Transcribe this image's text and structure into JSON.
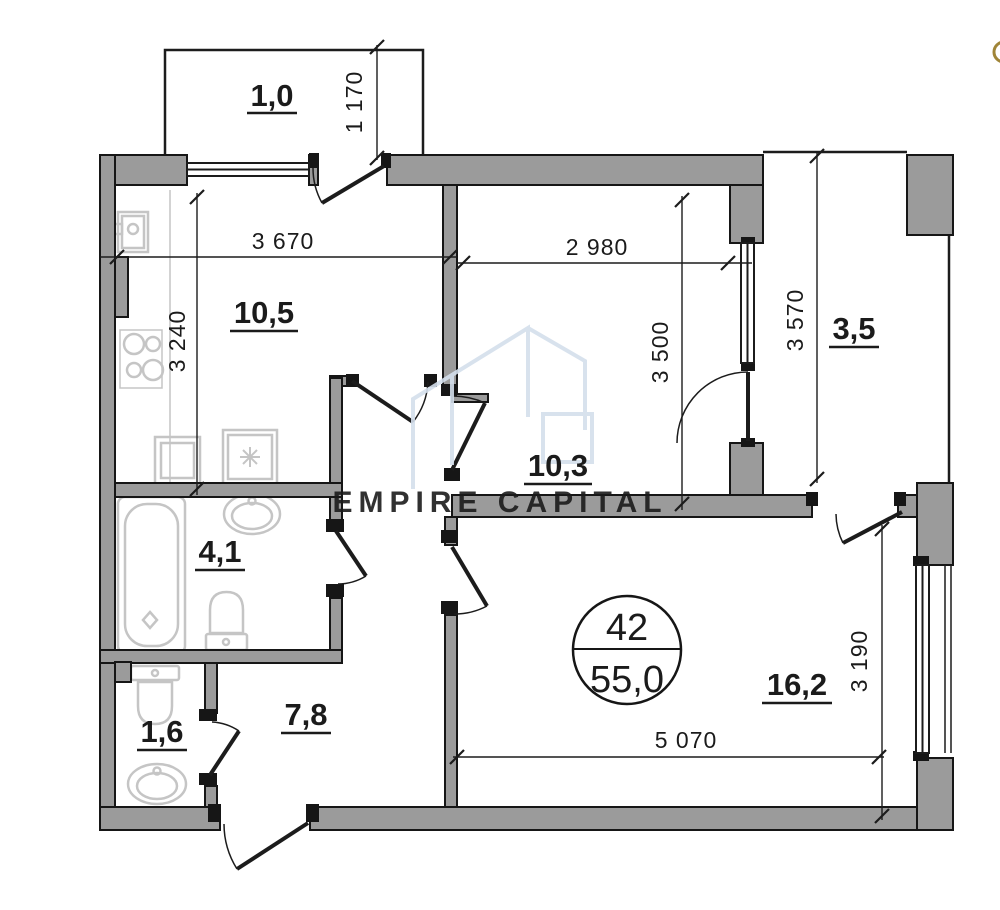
{
  "plan": {
    "badge": {
      "number": "42",
      "total_area": "55,0"
    },
    "watermark": {
      "brand": "EMPIRE CAPITAL"
    },
    "rooms": [
      {
        "name": "balcony-top",
        "area": "1,0"
      },
      {
        "name": "kitchen",
        "area": "10,5"
      },
      {
        "name": "bedroom",
        "area": "10,3"
      },
      {
        "name": "balcony-right",
        "area": "3,5"
      },
      {
        "name": "bathroom",
        "area": "4,1"
      },
      {
        "name": "wc",
        "area": "1,6"
      },
      {
        "name": "hallway",
        "area": "7,8"
      },
      {
        "name": "living-room",
        "area": "16,2"
      }
    ],
    "dims": {
      "d1170": "1 170",
      "d3670": "3 670",
      "d2980": "2 980",
      "d3240": "3 240",
      "d3500": "3 500",
      "d3570": "3 570",
      "d3190": "3 190",
      "d5070": "5 070"
    },
    "colors": {
      "wall": "#9b9b9b",
      "post": "#161616",
      "line": "#1c1c1c",
      "fixture": "#c5c5c5",
      "watermark": "#d4dfec",
      "accent_dot": "#a08538"
    }
  }
}
